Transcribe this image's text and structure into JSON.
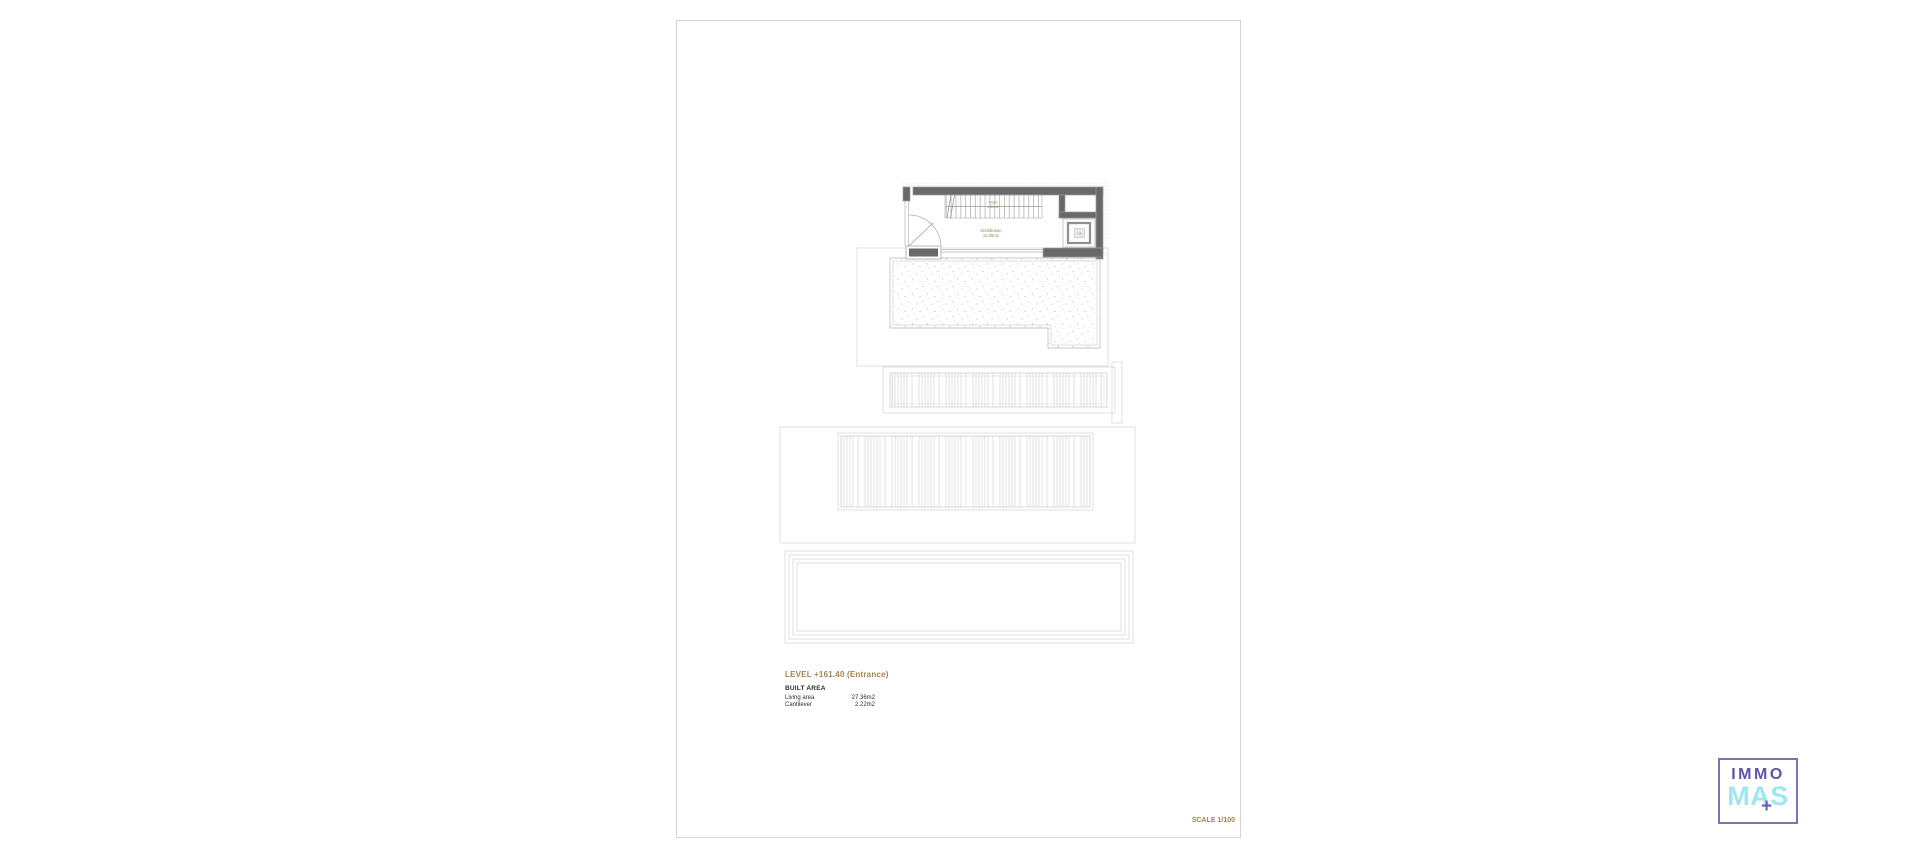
{
  "page": {
    "background": "#ffffff",
    "sheet_border": "#d3d3d3"
  },
  "plan": {
    "rooms": {
      "stairs_label": "Stairs",
      "stairs_area": "4.85m2",
      "distribution_label": "Distribution",
      "distribution_area": "12.05m2",
      "lift_label": "Lift"
    },
    "colors": {
      "wall": "#696969",
      "wall_outline": "#9d9d9d",
      "room_label": "#9a8756",
      "ghost_outline": "#d9d9d9",
      "stipple_dot": "#9f9f9f"
    }
  },
  "info": {
    "level_title": "LEVEL +161.40 (Entrance)",
    "built_area_heading": "BUILT AREA",
    "rows": [
      {
        "label": "Living area",
        "value": "27.36m2"
      },
      {
        "label": "Cantilever",
        "value": "2.22m2"
      }
    ],
    "scale": "SCALE 1/100"
  },
  "logo": {
    "line1": "IMMO",
    "line2": "MAS",
    "plus": "+",
    "colors": {
      "purple": "#5f55a5",
      "cyan": "#9ce7f2",
      "border": "#7a74b0"
    }
  }
}
